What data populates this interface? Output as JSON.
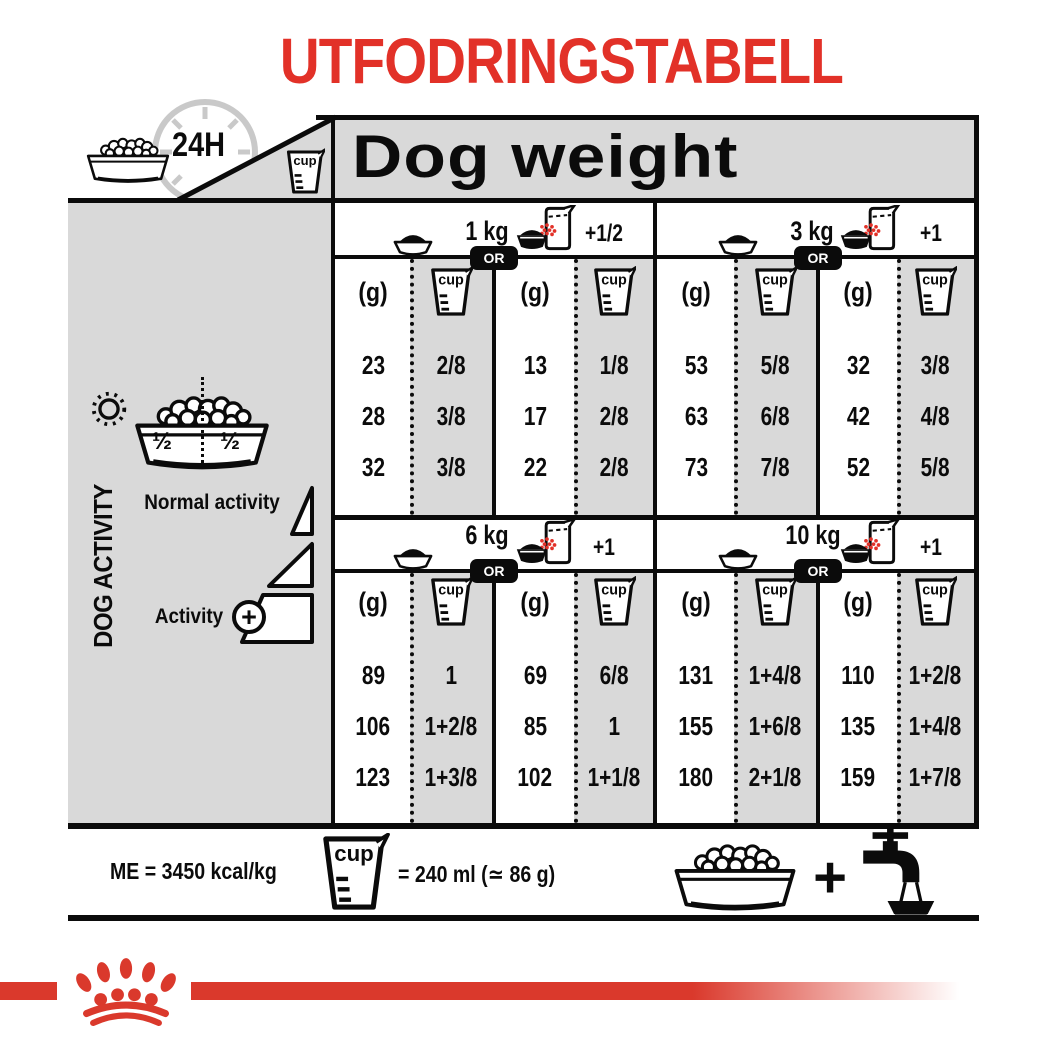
{
  "colors": {
    "red": "#e23128",
    "panel_gray": "#d9d9d9",
    "clock_gray": "#c9c9c9",
    "ink": "#0b0b0b"
  },
  "title": "UTFODRINGSTABELL",
  "header": {
    "clock": "24H",
    "dog_weight": "Dog weight"
  },
  "labels": {
    "g": "(g)",
    "cup": "cup",
    "or": "OR"
  },
  "sidebar": {
    "dog_activity": "DOG ACTIVITY",
    "half_left": "½",
    "half_right": "½",
    "normal_activity": "Normal activity",
    "activity": "Activity",
    "plus": "+"
  },
  "sections": [
    {
      "groups": [
        {
          "weight": "1 kg",
          "extra": "+1/2",
          "bowl_g": [
            "23",
            "28",
            "32"
          ],
          "bowl_cup": [
            "2/8",
            "3/8",
            "3/8"
          ],
          "pack_g": [
            "13",
            "17",
            "22"
          ],
          "pack_cup": [
            "1/8",
            "2/8",
            "2/8"
          ]
        },
        {
          "weight": "3 kg",
          "extra": "+1",
          "bowl_g": [
            "53",
            "63",
            "73"
          ],
          "bowl_cup": [
            "5/8",
            "6/8",
            "7/8"
          ],
          "pack_g": [
            "32",
            "42",
            "52"
          ],
          "pack_cup": [
            "3/8",
            "4/8",
            "5/8"
          ]
        }
      ]
    },
    {
      "groups": [
        {
          "weight": "6 kg",
          "extra": "+1",
          "bowl_g": [
            "89",
            "106",
            "123"
          ],
          "bowl_cup": [
            "1",
            "1+2/8",
            "1+3/8"
          ],
          "pack_g": [
            "69",
            "85",
            "102"
          ],
          "pack_cup": [
            "6/8",
            "1",
            "1+1/8"
          ]
        },
        {
          "weight": "10 kg",
          "extra": "+1",
          "bowl_g": [
            "131",
            "155",
            "180"
          ],
          "bowl_cup": [
            "1+4/8",
            "1+6/8",
            "2+1/8"
          ],
          "pack_g": [
            "110",
            "135",
            "159"
          ],
          "pack_cup": [
            "1+2/8",
            "1+4/8",
            "1+7/8"
          ]
        }
      ]
    }
  ],
  "footer": {
    "me": "ME = 3450 kcal/kg",
    "cup_equiv": "= 240 ml (≃ 86 g)",
    "plus": "+"
  }
}
